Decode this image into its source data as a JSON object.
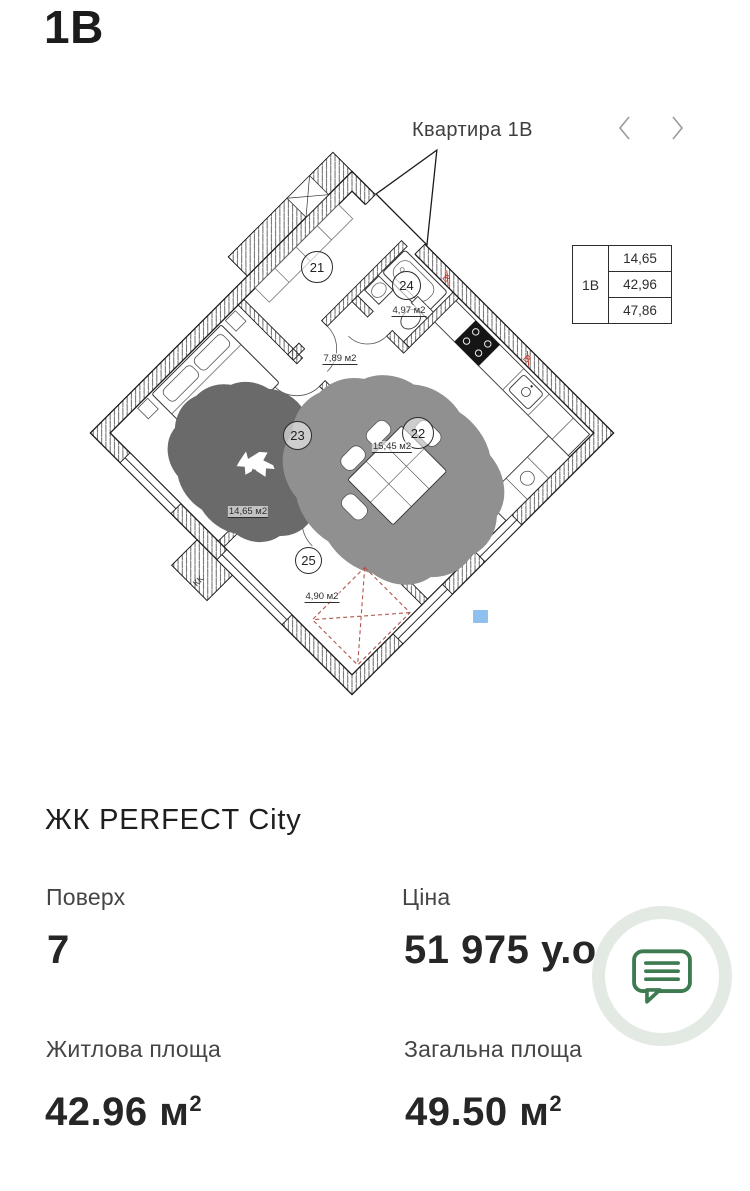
{
  "header": {
    "code": "1В"
  },
  "carousel": {
    "title": "Квартира 1В"
  },
  "plan": {
    "info_table": {
      "unit": "1В",
      "values": [
        "14,65",
        "42,96",
        "47,86"
      ]
    },
    "rooms": [
      {
        "number": "21",
        "area": "7,89 м2"
      },
      {
        "number": "22",
        "area": "15,45 м2"
      },
      {
        "number": "23",
        "area": "14,65 м2"
      },
      {
        "number": "24",
        "area": "4,97 м2"
      },
      {
        "number": "25",
        "area": "4,90 м2"
      }
    ],
    "annotations": {
      "kk": "КК",
      "vent": "В"
    }
  },
  "details": {
    "complex_name": "ЖК PERFECT City",
    "floor_label": "Поверх",
    "floor_value": "7",
    "price_label": "Ціна",
    "price_value": "51 975 у.о.",
    "living_area_label": "Житлова площа",
    "living_area_value": "42.96",
    "living_area_unit": "м",
    "living_area_sup": "2",
    "total_area_label": "Загальна площа",
    "total_area_value": "49.50",
    "total_area_unit": "м",
    "total_area_sup": "2"
  },
  "colors": {
    "accent_green": "#3e7b51",
    "ring_green": "#e2eae3",
    "marker_blue": "#8fc1f0",
    "vent_red": "#c0392b"
  }
}
